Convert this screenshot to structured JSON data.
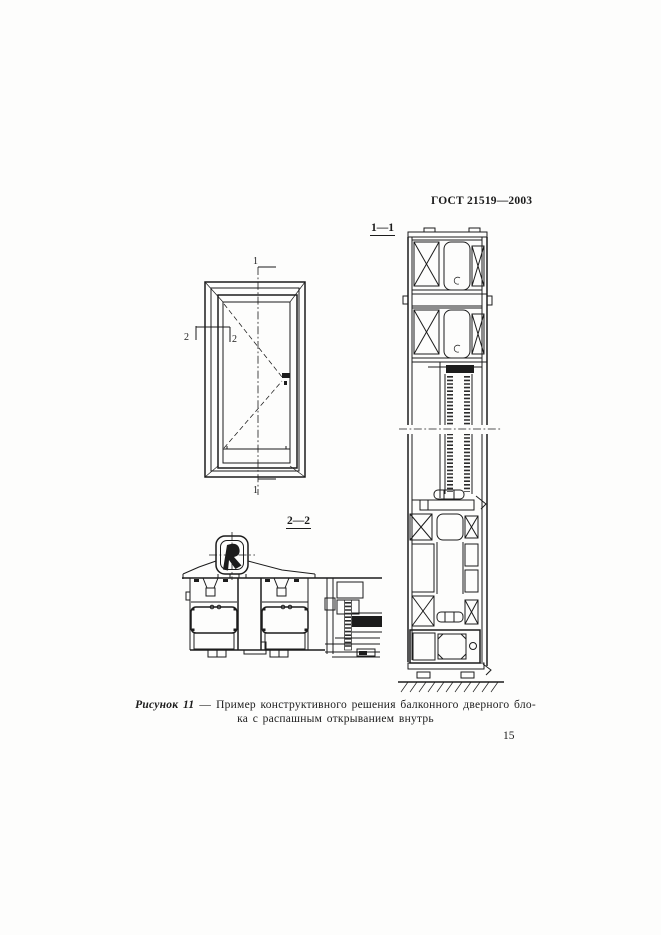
{
  "colors": {
    "paper": "#fdfdfc",
    "ink": "#1c1c1c"
  },
  "header": {
    "doc_code": "ГОСТ 21519—2003"
  },
  "figure": {
    "section1_label": "1—1",
    "section2_label": "2—2",
    "elevation": {
      "marker_1_top": "1",
      "marker_1_bottom": "1",
      "marker_2_left": "2",
      "marker_2_right": "2"
    }
  },
  "caption": {
    "figure_ref": "Рисунок 11",
    "dash": "—",
    "text_line1": "Пример конструктивного решения балконного дверного бло-",
    "text_line2": "ка с распашным открыванием внутрь"
  },
  "footer": {
    "page_number": "15"
  }
}
